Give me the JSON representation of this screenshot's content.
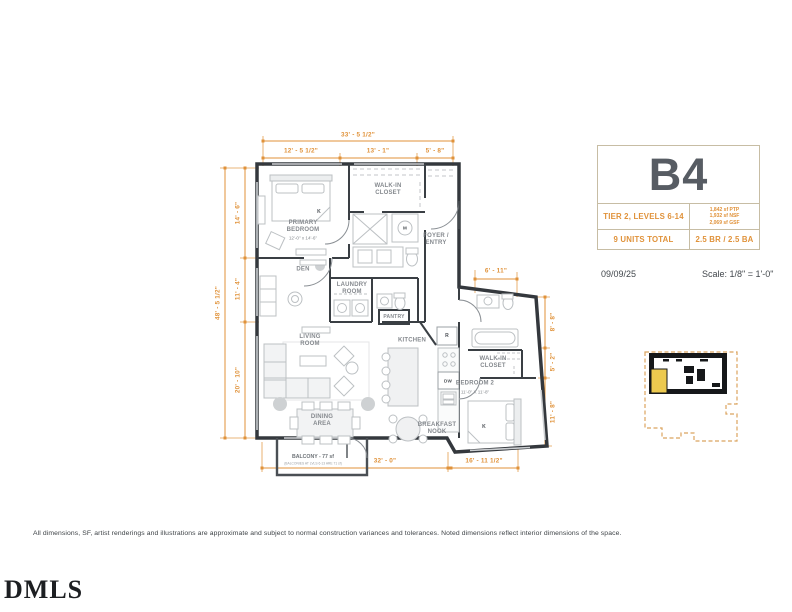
{
  "unit_card": {
    "unit_name": "B4",
    "tier_levels": "TIER 2, LEVELS 6-14",
    "areas": {
      "line1": "1,842 sf PTP",
      "line2": "1,932 sf NSF",
      "line3": "2,069 sf GSF"
    },
    "units_total": "9 UNITS TOTAL",
    "bed_bath": "2.5 BR / 2.5 BA"
  },
  "meta": {
    "date": "09/09/25",
    "scale": "Scale:  1/8\" = 1'-0\""
  },
  "rooms": {
    "walk_in_closet_1": "WALK-IN\nCLOSET",
    "primary_bedroom": "PRIMARY\nBEDROOM",
    "primary_bedroom_dims": "12'-0\" x 14'-6\"",
    "foyer": "FOYER /\nENTRY",
    "den": "DEN",
    "laundry": "LAUNDRY\nROOM",
    "pantry": "PANTRY",
    "living": "LIVING\nROOM",
    "kitchen": "KITCHEN",
    "dining": "DINING\nAREA",
    "breakfast": "BREAKFAST\nNOOK",
    "bedroom2": "BEDROOM 2",
    "bedroom2_dims": "11'-0\" X 11'-8\"",
    "walk_in_closet_2": "WALK-IN\nCLOSET",
    "balcony": "BALCONY - 77 sf",
    "balcony_note": "(BALCONIES AT LVLS 6-13 ARE 71 sf)"
  },
  "fixtures": {
    "bed_primary": "K",
    "bed_2": "K",
    "fridge": "R",
    "dishwasher": "DW",
    "mech": "M"
  },
  "dimensions": {
    "top_overall": "33' - 5 1/2\"",
    "top_a": "12' - 5 1/2\"",
    "top_b": "13' - 1\"",
    "top_c": "5' - 8\"",
    "left_overall": "48' - 5 1/2\"",
    "left_a": "14' - 6\"",
    "left_b": "11' - 4\"",
    "left_c": "20' - 10\"",
    "right_a": "8' - 8\"",
    "right_b": "5' - 2\"",
    "right_c": "11' - 8\"",
    "wing_top": "6' - 11\"",
    "bottom_a": "32' - 0\"",
    "bottom_b": "16' - 11 1/2\""
  },
  "footer": {
    "disclaimer": "All dimensions, SF, artist renderings and illustrations are approximate and subject to normal construction variances and tolerances. Noted dimensions reflect interior dimensions of the space.",
    "logo": "DMLS"
  },
  "colors": {
    "dimension_orange": "#e0923a",
    "unit_highlight_yellow": "#ecc94f",
    "wall_dark": "#34383d",
    "keyplan_dash": "#dba45f"
  }
}
